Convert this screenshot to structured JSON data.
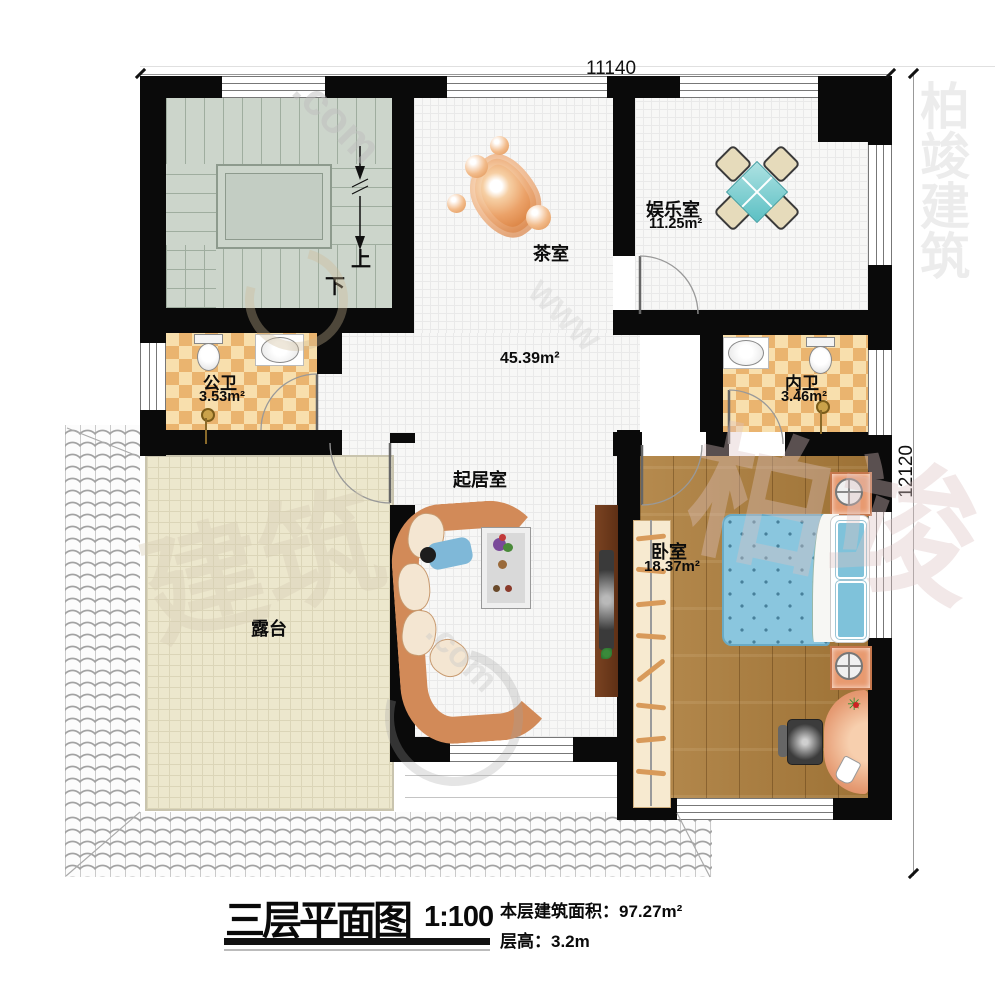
{
  "plan": {
    "dims": {
      "top": "11140",
      "right": "12120"
    },
    "stairs": {
      "up": "上",
      "down": "下"
    },
    "rooms": {
      "tea": {
        "name": "茶室"
      },
      "entertainment": {
        "name": "娱乐室",
        "area": "11.25m²"
      },
      "public_bath": {
        "name": "公卫",
        "area": "3.53m²"
      },
      "ensuite_bath": {
        "name": "内卫",
        "area": "3.46m²"
      },
      "living": {
        "name": "起居室",
        "area": "45.39m²"
      },
      "bedroom": {
        "name": "卧室",
        "area": "18.37m²"
      },
      "terrace": {
        "name": "露台"
      }
    },
    "watermarks": [
      ".com",
      "WWW",
      "建筑",
      "柏竣",
      "柏竣建筑",
      ".com"
    ]
  },
  "titleblock": {
    "title": "三层平面图",
    "scale": "1:100",
    "area_line": "本层建筑面积：97.27m²",
    "height_line": "层高：3.2m"
  }
}
